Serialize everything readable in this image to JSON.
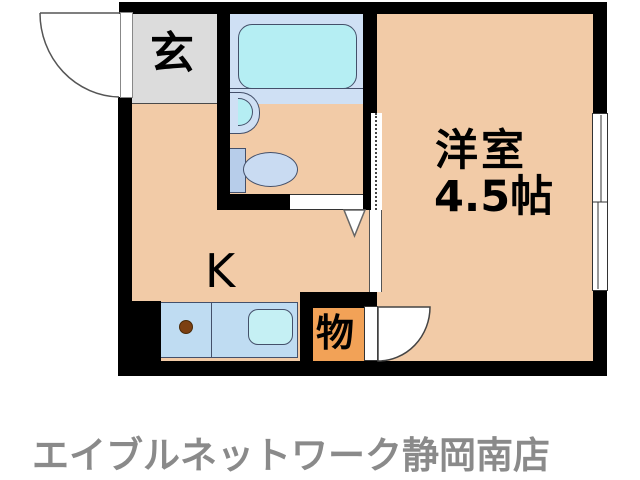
{
  "floorplan": {
    "rooms": {
      "entrance": {
        "label": "玄"
      },
      "kitchen": {
        "label": "K"
      },
      "western_room": {
        "label": "洋室",
        "size": "4.5帖"
      },
      "storage": {
        "label": "物"
      }
    },
    "footer": {
      "agency": "エイブルネットワーク静岡南店"
    },
    "colors": {
      "wall": "#000000",
      "room_floor": "#f2cba7",
      "entrance_floor": "#dcdcdc",
      "bathroom_floor": "#cfe0f4",
      "bathroom_floor_lower": "#dfeafa",
      "bathtub": "#b5eef3",
      "storage_floor": "#f2a257",
      "counter": "#bfdcf2",
      "sink": "#c5f0f4",
      "burner": "#7c4012",
      "footer_text": "#8a8a8a"
    }
  }
}
